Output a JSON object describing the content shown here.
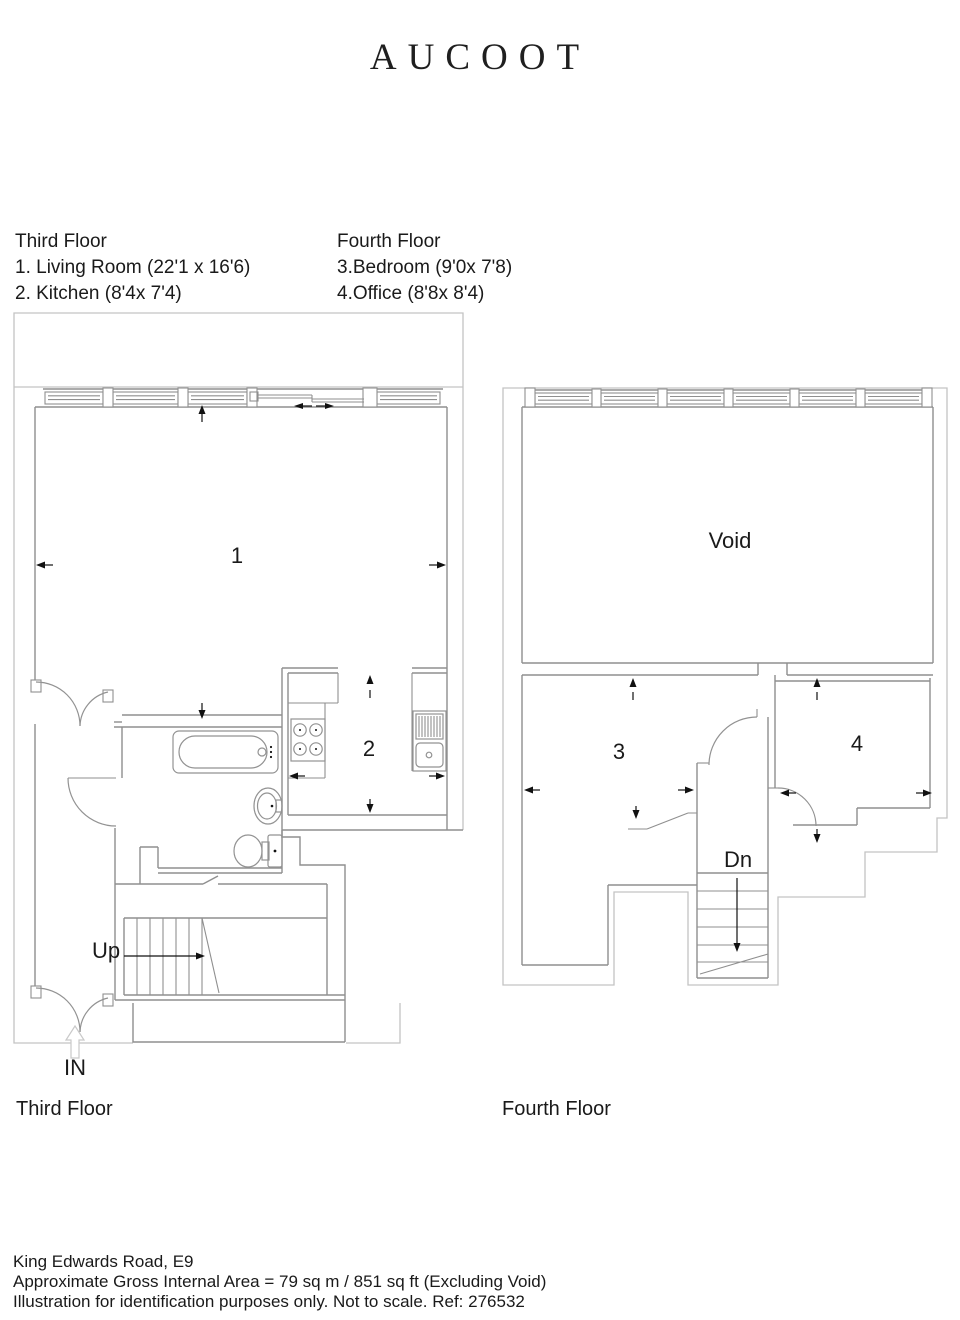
{
  "brand": {
    "title": "AUCOOT"
  },
  "legend": {
    "third": {
      "title": "Third Floor",
      "items": [
        "1. Living Room (22'1 x 16'6)",
        "2. Kitchen (8'4x 7'4)"
      ]
    },
    "fourth": {
      "title": "Fourth Floor",
      "items": [
        "3.Bedroom (9'0x 7'8)",
        "4.Office (8'8x 8'4)"
      ]
    }
  },
  "plan_third": {
    "caption": "Third Floor",
    "living_room_label": "1",
    "kitchen_label": "2",
    "stairs_label": "Up",
    "entrance_label": "IN"
  },
  "plan_fourth": {
    "caption": "Fourth Floor",
    "void_label": "Void",
    "bedroom_label": "3",
    "office_label": "4",
    "stairs_label": "Dn"
  },
  "footer": {
    "address": "King Edwards Road, E9",
    "area": "Approximate Gross Internal Area = 79 sq m / 851 sq ft (Excluding Void)",
    "disclaimer": "Illustration for identification purposes only. Not to scale. Ref: 276532"
  },
  "colors": {
    "wall": "#8f8f8f",
    "outline": "#c3c3c3",
    "ink": "#1a1a1a"
  }
}
